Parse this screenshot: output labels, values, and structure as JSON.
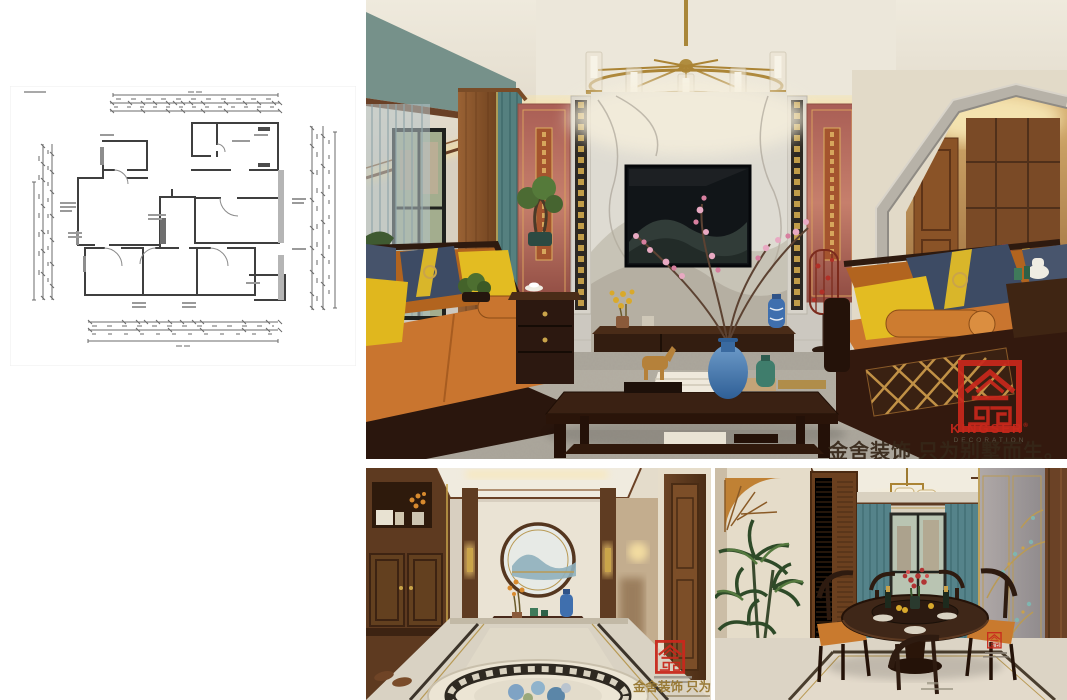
{
  "branding": {
    "logo_name": "KINGSER",
    "logo_reg": "®",
    "logo_subtitle": "DECORATION",
    "slogan": "金舍装饰 只为别墅而生。",
    "slogan_short": "金舍装饰 只为别墅而生",
    "seal_color": "#c9281c",
    "gold_accent": "#b9974b"
  },
  "palette": {
    "sofa_orange": "#c9752f",
    "pillow_yellow": "#e3bc22",
    "pillow_navy": "#3d4b64",
    "curtain_teal": "#5d8587",
    "panel_pink": "#b06a62",
    "wood_dark": "#33190e",
    "marble_gray": "#dedbd2"
  }
}
